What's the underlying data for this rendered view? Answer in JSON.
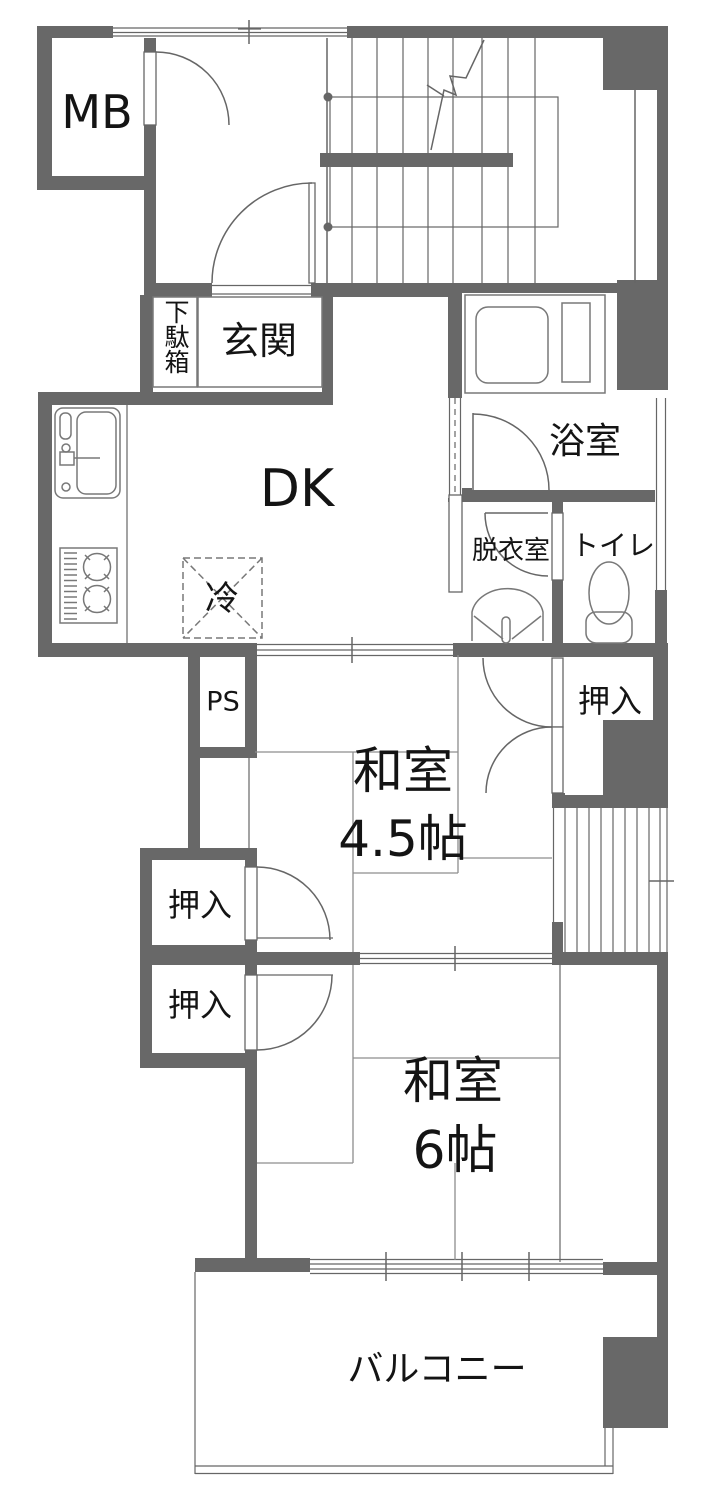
{
  "rooms": {
    "mb": "MB",
    "genkan": "玄関",
    "getabako": "下駄箱",
    "dk": "DK",
    "fridge": "冷",
    "bath": "浴室",
    "dressing": "脱衣室",
    "toilet": "トイレ",
    "ps": "PS",
    "closet_right": "押入",
    "closet_upper_left": "押入",
    "closet_lower_left": "押入",
    "washitsu45_name": "和室",
    "washitsu45_size": "4.5帖",
    "washitsu6_name": "和室",
    "washitsu6_size": "6帖",
    "balcony": "バルコニー"
  },
  "colors": {
    "wall": "#686868",
    "line": "#666666",
    "tatami": "#8d8d8d",
    "text": "#141414",
    "bg": "#ffffff"
  }
}
